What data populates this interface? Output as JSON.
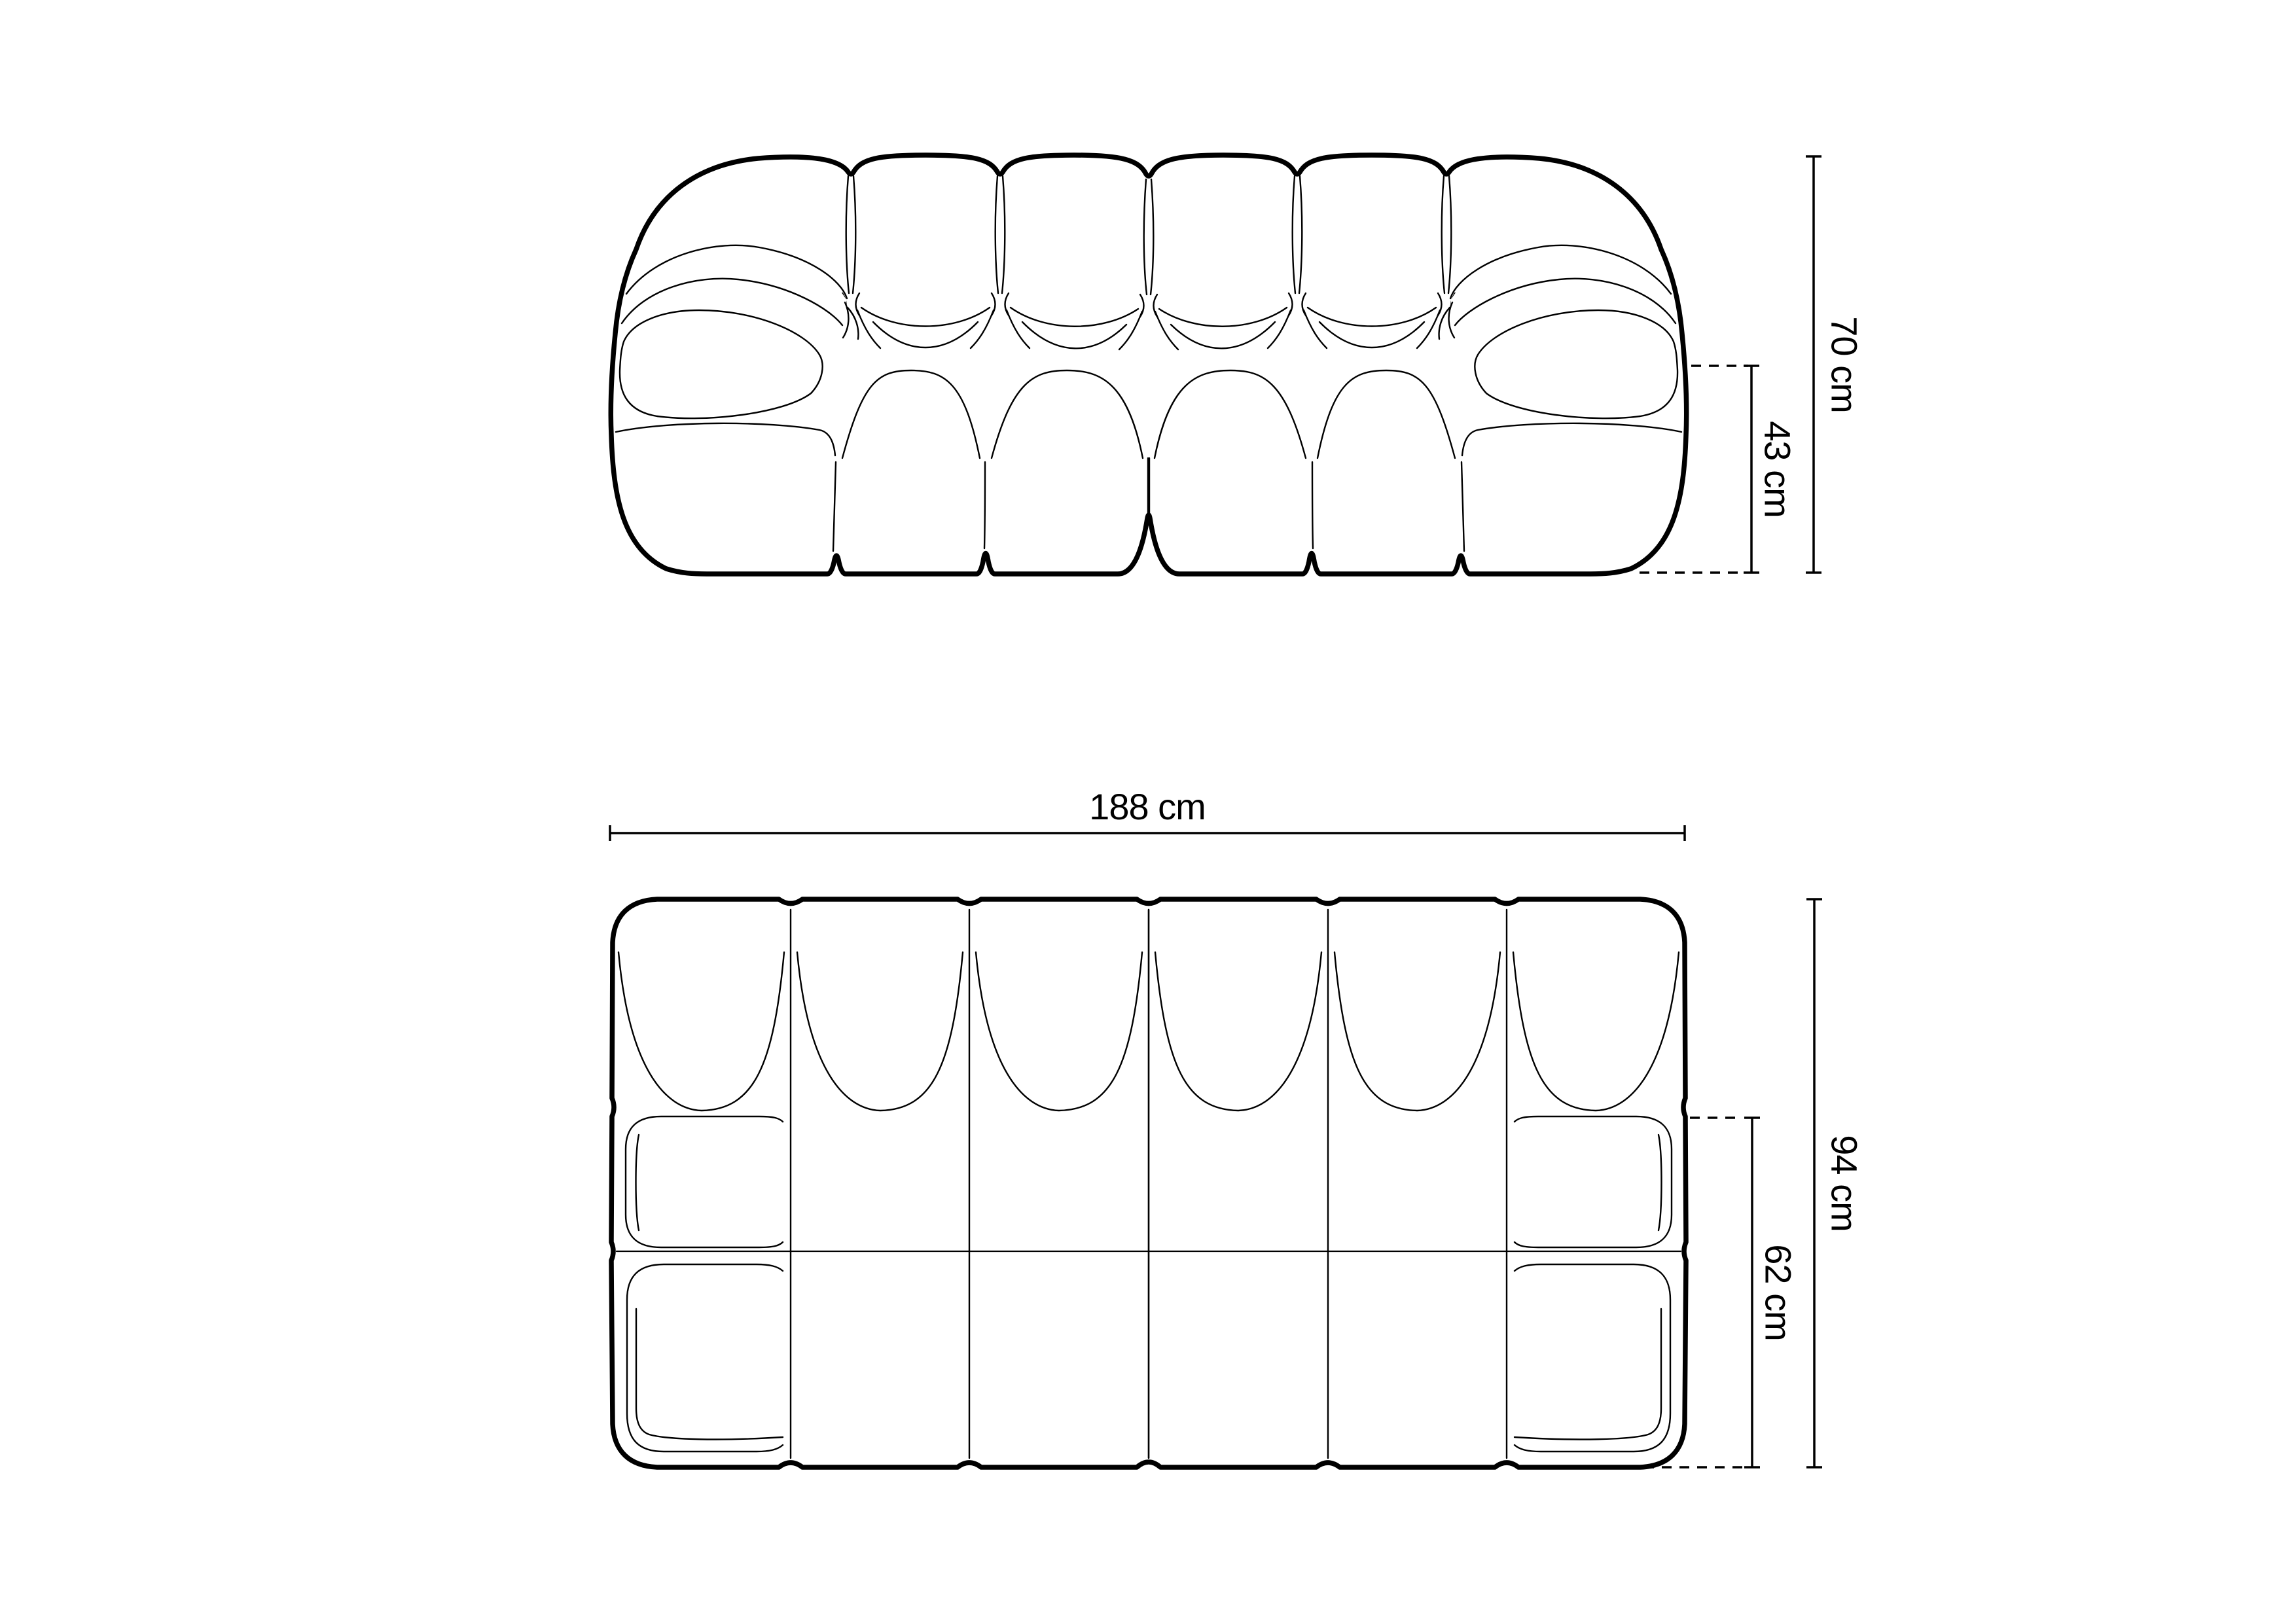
{
  "page": {
    "background": "#ffffff",
    "ink": "#000000"
  },
  "drawing": {
    "type": "furniture-dimension-diagram",
    "subject": "modular bubble sofa, two views (front elevation and top plan)",
    "views": {
      "front": {
        "title": "front elevation",
        "back_cushions": 6,
        "armrests": 2,
        "dimensions": {
          "total_height": {
            "label": "70 cm",
            "value": 70,
            "unit": "cm"
          },
          "seat_height": {
            "label": "43 cm",
            "value": 43,
            "unit": "cm"
          }
        }
      },
      "plan": {
        "title": "top view",
        "modules_across": 6,
        "module_rows": 3,
        "dimensions": {
          "total_width": {
            "label": "188 cm",
            "value": 188,
            "unit": "cm"
          },
          "total_depth": {
            "label": "94 cm",
            "value": 94,
            "unit": "cm"
          },
          "seat_depth": {
            "label": "62 cm",
            "value": 62,
            "unit": "cm"
          }
        }
      }
    }
  }
}
